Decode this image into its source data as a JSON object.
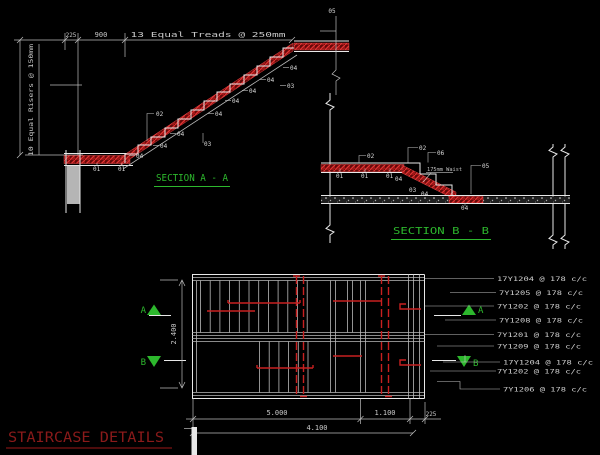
{
  "drawing_title": "STAIRCASE DETAILS",
  "colors": {
    "background": "#000000",
    "line_white": "#e8e8e8",
    "rebar_red": "#c82020",
    "hatch_red_dark": "#7e0d0d",
    "annotation_green": "#2db82d",
    "title_red": "#8a1a1a",
    "dim_gray": "#c9c9c9",
    "wall_gray": "#b5b5b5"
  },
  "section_a": {
    "title": "SECTION A - A",
    "dims": {
      "d225": "225",
      "d900": "900",
      "treads_note": "13 Equal Treads @ 250mm",
      "risers_note": "10 Equal Risers @ 150mm"
    }
  },
  "section_b": {
    "title": "SECTION B - B",
    "waist_note": "175mm Waist"
  },
  "marks": {
    "m01": "01",
    "m02": "02",
    "m03": "03",
    "m04": "04",
    "m05": "05",
    "m06": "06"
  },
  "plan": {
    "dims": {
      "width": "2.400",
      "going": "5.000",
      "landing": "1.100",
      "wall": "225",
      "total": "4.100"
    },
    "section_markers": {
      "a": "A",
      "b": "B"
    },
    "callouts": [
      "17Y1204 @ 178 c/c",
      "7Y1205 @ 178 c/c",
      "7Y1202 @ 178 c/c",
      "7Y1208 @ 178 c/c",
      "7Y1201 @ 178 c/c",
      "7Y1209 @ 178 c/c",
      "17Y1204 @ 178 c/c",
      "7Y1202 @ 178 c/c",
      "7Y1206 @ 178 c/c"
    ]
  }
}
